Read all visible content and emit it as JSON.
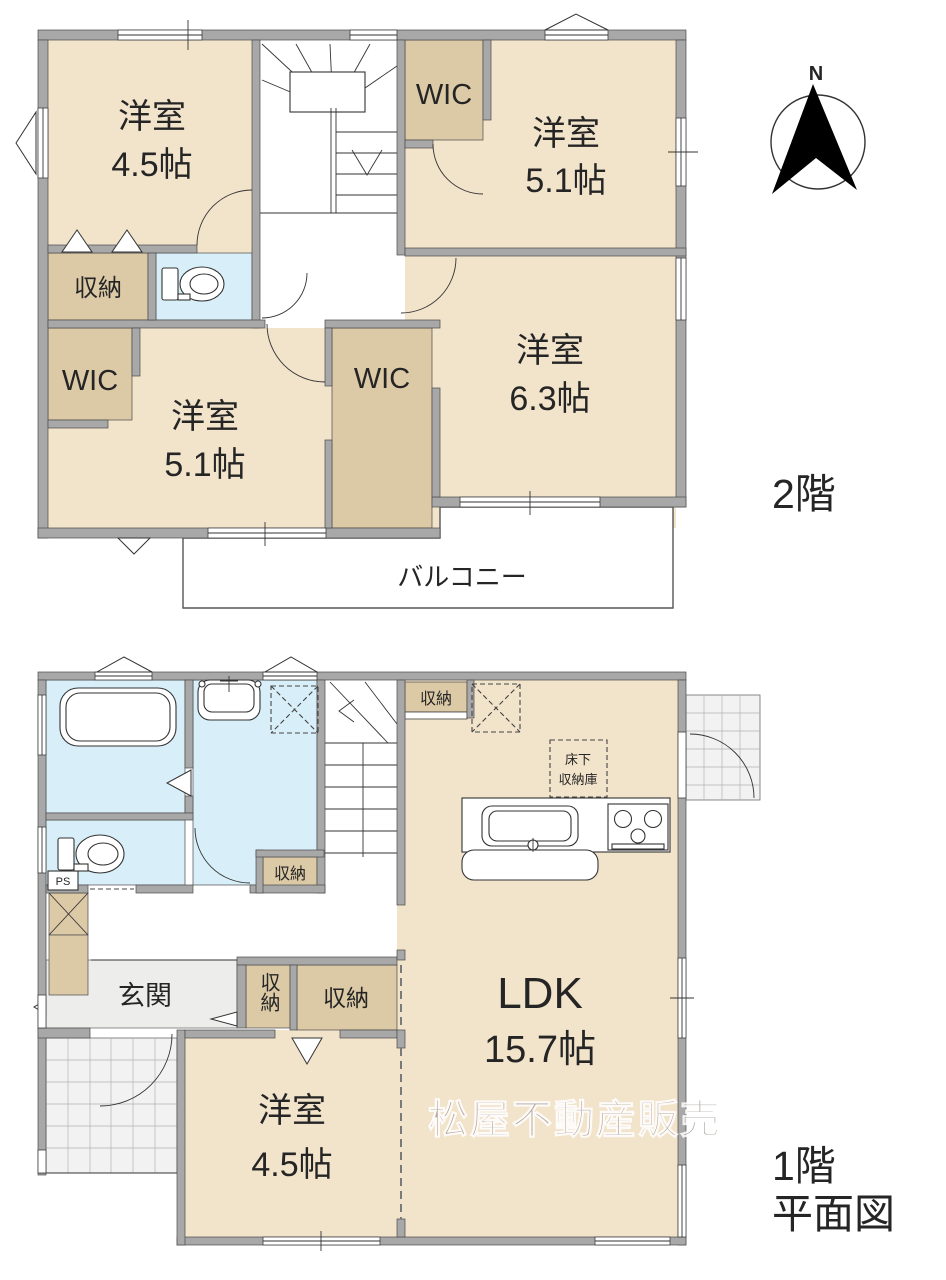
{
  "floors": {
    "f2": {
      "floor_label": "2階",
      "room_45": {
        "name": "洋室",
        "size": "4.5帖"
      },
      "wic_top": "WIC",
      "room_51_top": {
        "name": "洋室",
        "size": "5.1帖"
      },
      "closet": "収納",
      "wic_left": "WIC",
      "room_51_bottom": {
        "name": "洋室",
        "size": "5.1帖"
      },
      "wic_mid": "WIC",
      "room_63": {
        "name": "洋室",
        "size": "6.3帖"
      },
      "balcony": "バルコニー"
    },
    "f1": {
      "floor_label_line1": "1階",
      "floor_label_line2": "平面図",
      "entrance": "玄関",
      "ps": "PS",
      "closet_stairs": "収納",
      "closet_hall": "収納",
      "closet_entry_small": "収納",
      "closet_entry_large": "収納",
      "underfloor_line1": "床下",
      "underfloor_line2": "収納庫",
      "room_45": {
        "name": "洋室",
        "size": "4.5帖"
      },
      "ldk": {
        "name": "LDK",
        "size": "15.7帖"
      }
    }
  },
  "compass_north": "N",
  "watermark": "松屋不動産販売",
  "colors": {
    "room_floor": "#f2e3cb",
    "closet": "#dcc9a6",
    "wet_area": "#d8eff9",
    "wall": "#a8a8a8",
    "entrance_floor": "#ededeb"
  }
}
